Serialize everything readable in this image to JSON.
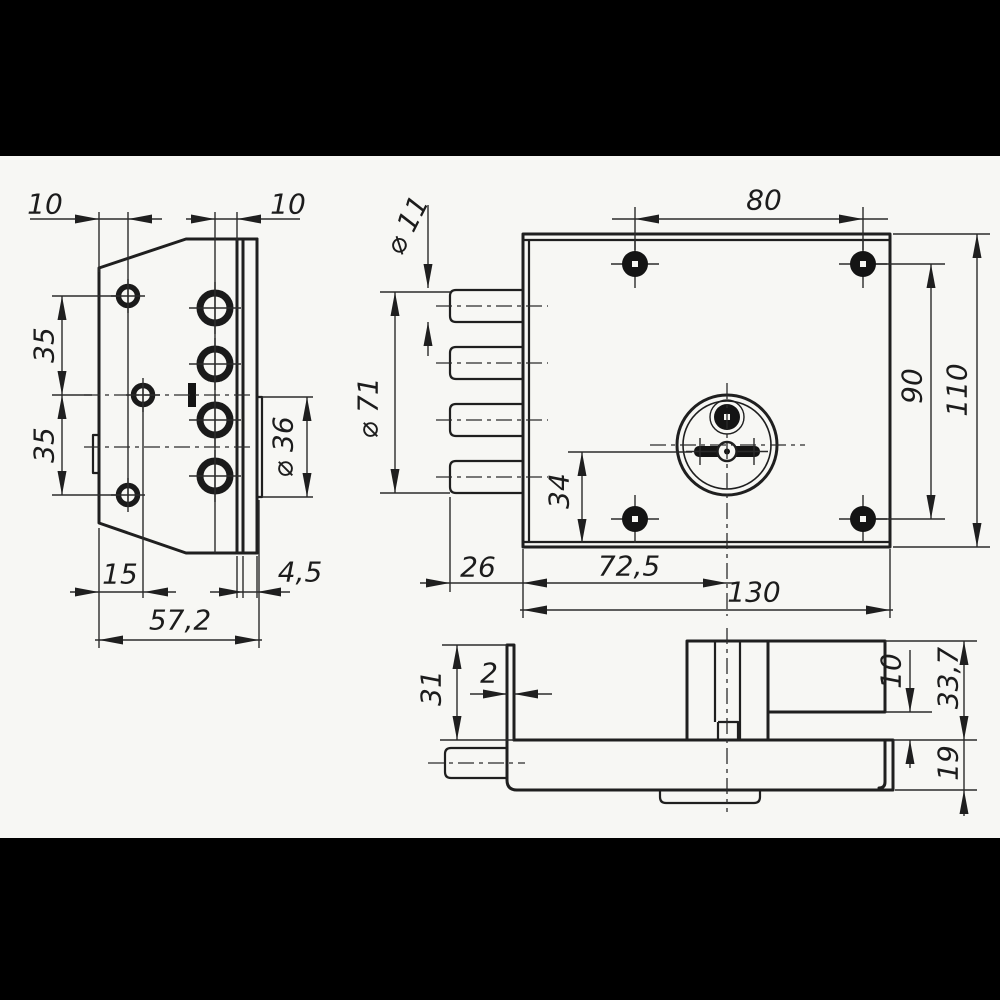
{
  "drawing": {
    "type": "engineering-drawing",
    "subject": "three-bolt rim door lock - orthographic views with dimensions",
    "units": "mm",
    "colors": {
      "line": "#1f1f1f",
      "paper": "#f7f7f4",
      "letterbox": "#000000"
    },
    "views": {
      "side_view": {
        "name": "left side view (lock edge with faceplate)",
        "dims": {
          "top_left_offset": "10",
          "top_right_offset": "10",
          "upper_hole_spacing": "35",
          "lower_hole_spacing": "35",
          "cylinder_ring_diameter": "⌀ 36",
          "hole_line_offset": "15",
          "faceplate_thickness": "4,5",
          "total_depth": "57,2"
        }
      },
      "front_view": {
        "name": "front view (lock body with bolts and cylinder)",
        "dims": {
          "bolt_diameter": "⌀ 11",
          "bolt_span_diameter": "⌀ 71",
          "screw_spacing_horizontal": "80",
          "screw_spacing_vertical": "90",
          "body_height": "110",
          "cylinder_axis_to_bottom": "34",
          "bolt_protrusion": "26",
          "cylinder_axis_offset": "72,5",
          "body_width": "130"
        }
      },
      "bottom_view": {
        "name": "bottom view (case depth with cylinder housing)",
        "dims": {
          "faceplate_height": "31",
          "faceplate_thickness": "2",
          "cover_step": "10",
          "housing_depth": "33,7",
          "case_depth": "19"
        }
      }
    }
  }
}
